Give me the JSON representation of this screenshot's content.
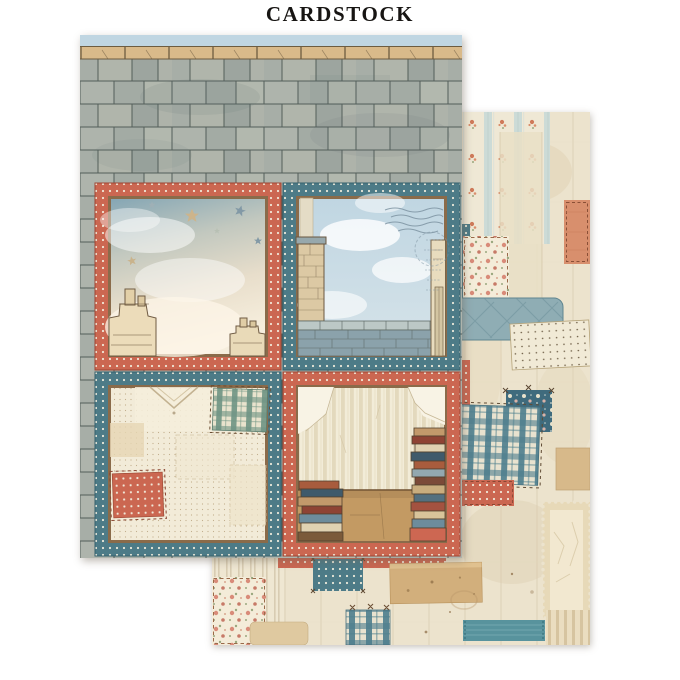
{
  "title": "CARDSTOCK",
  "sheets": {
    "front": {
      "name": "rooftop four-panel sheet",
      "header": "slate roof tiles with stone ridge under pale sky",
      "panels": [
        {
          "id": "top-left",
          "border": "coral polka dot",
          "scene": "starry watercolor sky with clouds and two rooftop chimneys"
        },
        {
          "id": "top-right",
          "border": "teal polka dot",
          "scene": "blue sky with clouds over slate parapet, stone chimney, building edge and postmark"
        },
        {
          "id": "bottom-left",
          "border": "teal polka dot",
          "scene": "cream dotted fabric with green plaid and coral polka patches"
        },
        {
          "id": "bottom-right",
          "border": "coral polka dot",
          "scene": "striped wallpaper with cracked plaster, wooden floor and stacked books"
        }
      ]
    },
    "back": {
      "name": "patchwork collage sheet",
      "elements": [
        "striped floral wallpaper",
        "linen patch",
        "salmon stitched patch",
        "cream rose floral patches",
        "quilted blue fabric",
        "cream pin-dot patch",
        "navy floral patch",
        "blue plaid patches",
        "coral polka patches",
        "teal polka patches",
        "kraft paper scraps",
        "postage stamp frame",
        "ticking stripe fabric",
        "teal woven ribbon",
        "cross stitches and stains"
      ]
    }
  },
  "palette": {
    "coral": "#cb6751",
    "teal": "#4d7b87",
    "slate": "#aab0a8",
    "cream": "#f2ebd8",
    "sky": "#c0d6e2",
    "wood": "#c39a63",
    "kraft": "#d2af7c",
    "ribbon": "#58939d",
    "base_paper": "#ece3cd",
    "ink": "#171513"
  }
}
